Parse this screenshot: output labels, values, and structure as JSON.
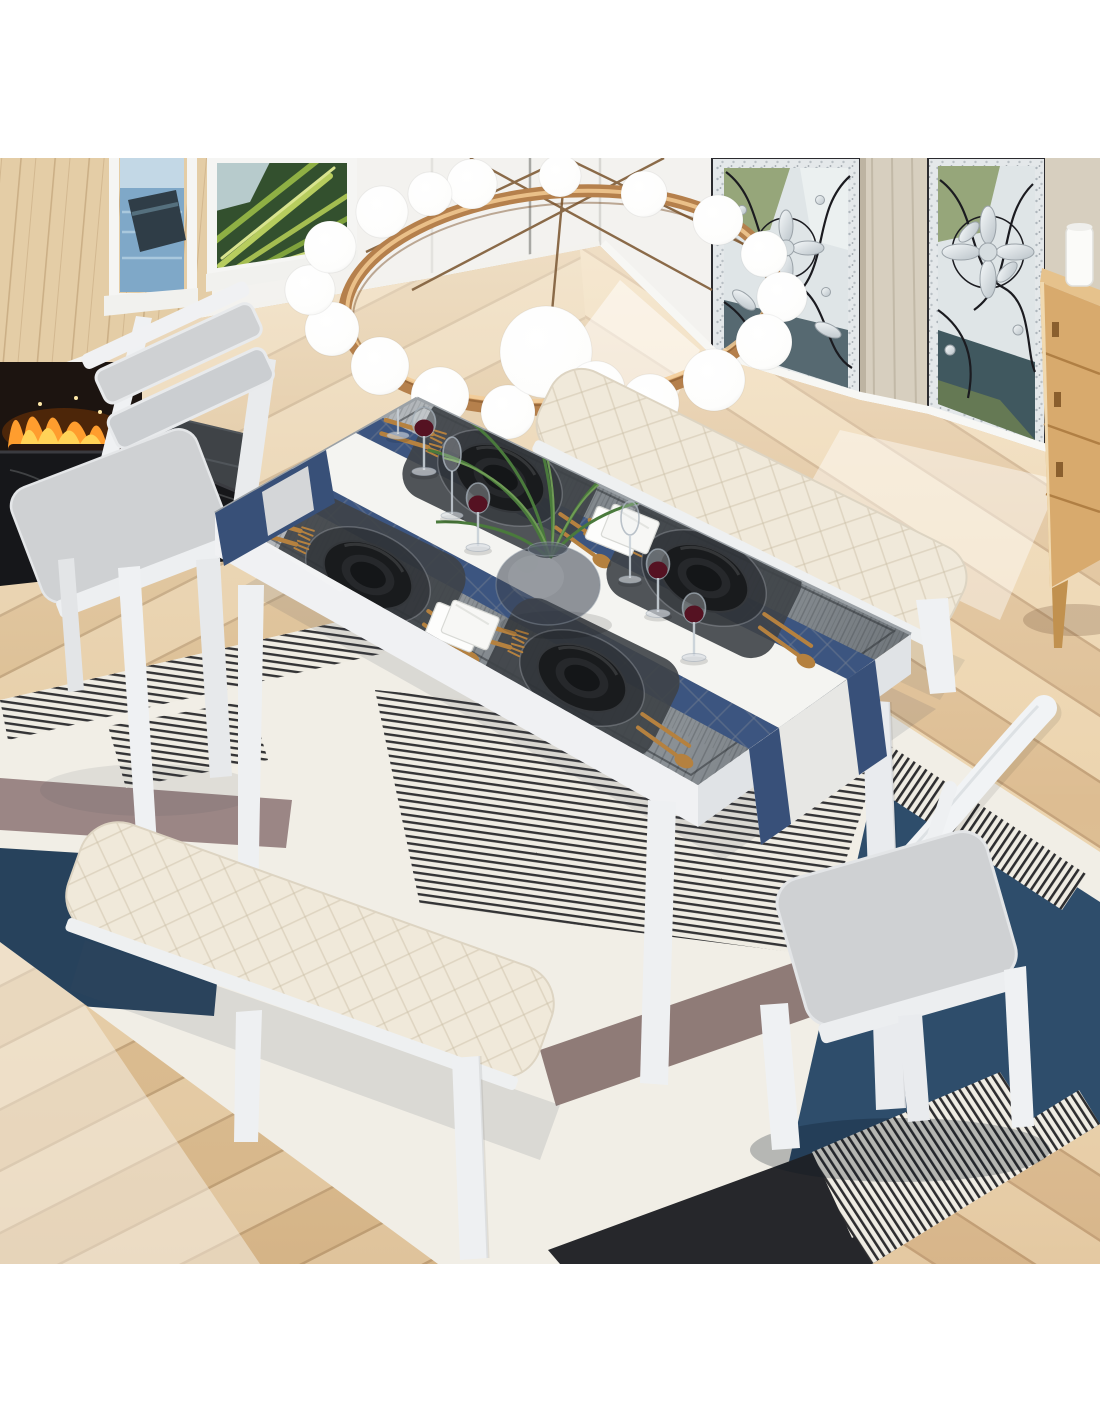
{
  "image": {
    "kind": "product-photo",
    "description": "Overhead dining room scene: 6-piece dining set with gray wood-top table on white legs set for four (black plates, gold cutlery, wine glasses, smoky glass vase with ferns, white napkins, blue-and-white runner), two cream upholstered benches, two white chairs with gray cushions, geometric navy/white/black/mauve area rug on light oak plank flooring, gold ring chandelier with white glass globes, tropical windows, stained-glass panels, black marble fireplace and oak cabinet."
  },
  "colors": {
    "wall": "#f3f2ef",
    "wood_wall": "#e4cda6",
    "floor": "#e0c49c",
    "table_top_mid": "#878d92",
    "table_frame": "#eff1f3",
    "runner_white": "#f4f4f1",
    "runner_blue": "#3c5580",
    "placemat": "#3e4347",
    "plate": "#191b1d",
    "cutlery_gold": "#b5813f",
    "wine": "#551222",
    "fern": "#4a7a3c",
    "bench_cream": "#f0e9da",
    "cushion_gray": "#cfd1d3",
    "rug_white": "#f1eee6",
    "rug_navy": "#2e4d6b",
    "rug_navy2": "#27425c",
    "rug_black": "#26272b",
    "rug_mauve": "#8f7b77",
    "rug_mauve2": "#9b8685",
    "chandelier_gold": "#b5804c",
    "globe_white": "#ffffff",
    "fire": "#ff9d2e",
    "marble": "#16171a",
    "cabinet": "#d8aa6d",
    "glass_panel": "#dfe5e7"
  },
  "scene": {
    "objects": [
      {
        "name": "dining-table",
        "label": "gray wood dining table"
      },
      {
        "name": "table-runner",
        "label": "blue and white runner"
      },
      {
        "name": "place-settings",
        "label": "four black plate settings with gold cutlery"
      },
      {
        "name": "bench-top",
        "label": "cream upholstered bench"
      },
      {
        "name": "bench-bottom",
        "label": "cream upholstered bench"
      },
      {
        "name": "chair-top-left",
        "label": "white chair with gray pads"
      },
      {
        "name": "chair-bottom-right",
        "label": "white chair, back view"
      },
      {
        "name": "area-rug",
        "label": "geometric navy/white rug"
      },
      {
        "name": "ring-chandelier",
        "label": "gold ring chandelier with globes"
      },
      {
        "name": "fireplace",
        "label": "black marble fireplace"
      },
      {
        "name": "oak-cabinet",
        "label": "oak drawer cabinet"
      },
      {
        "name": "stained-glass",
        "label": "stained glass windows"
      }
    ]
  }
}
